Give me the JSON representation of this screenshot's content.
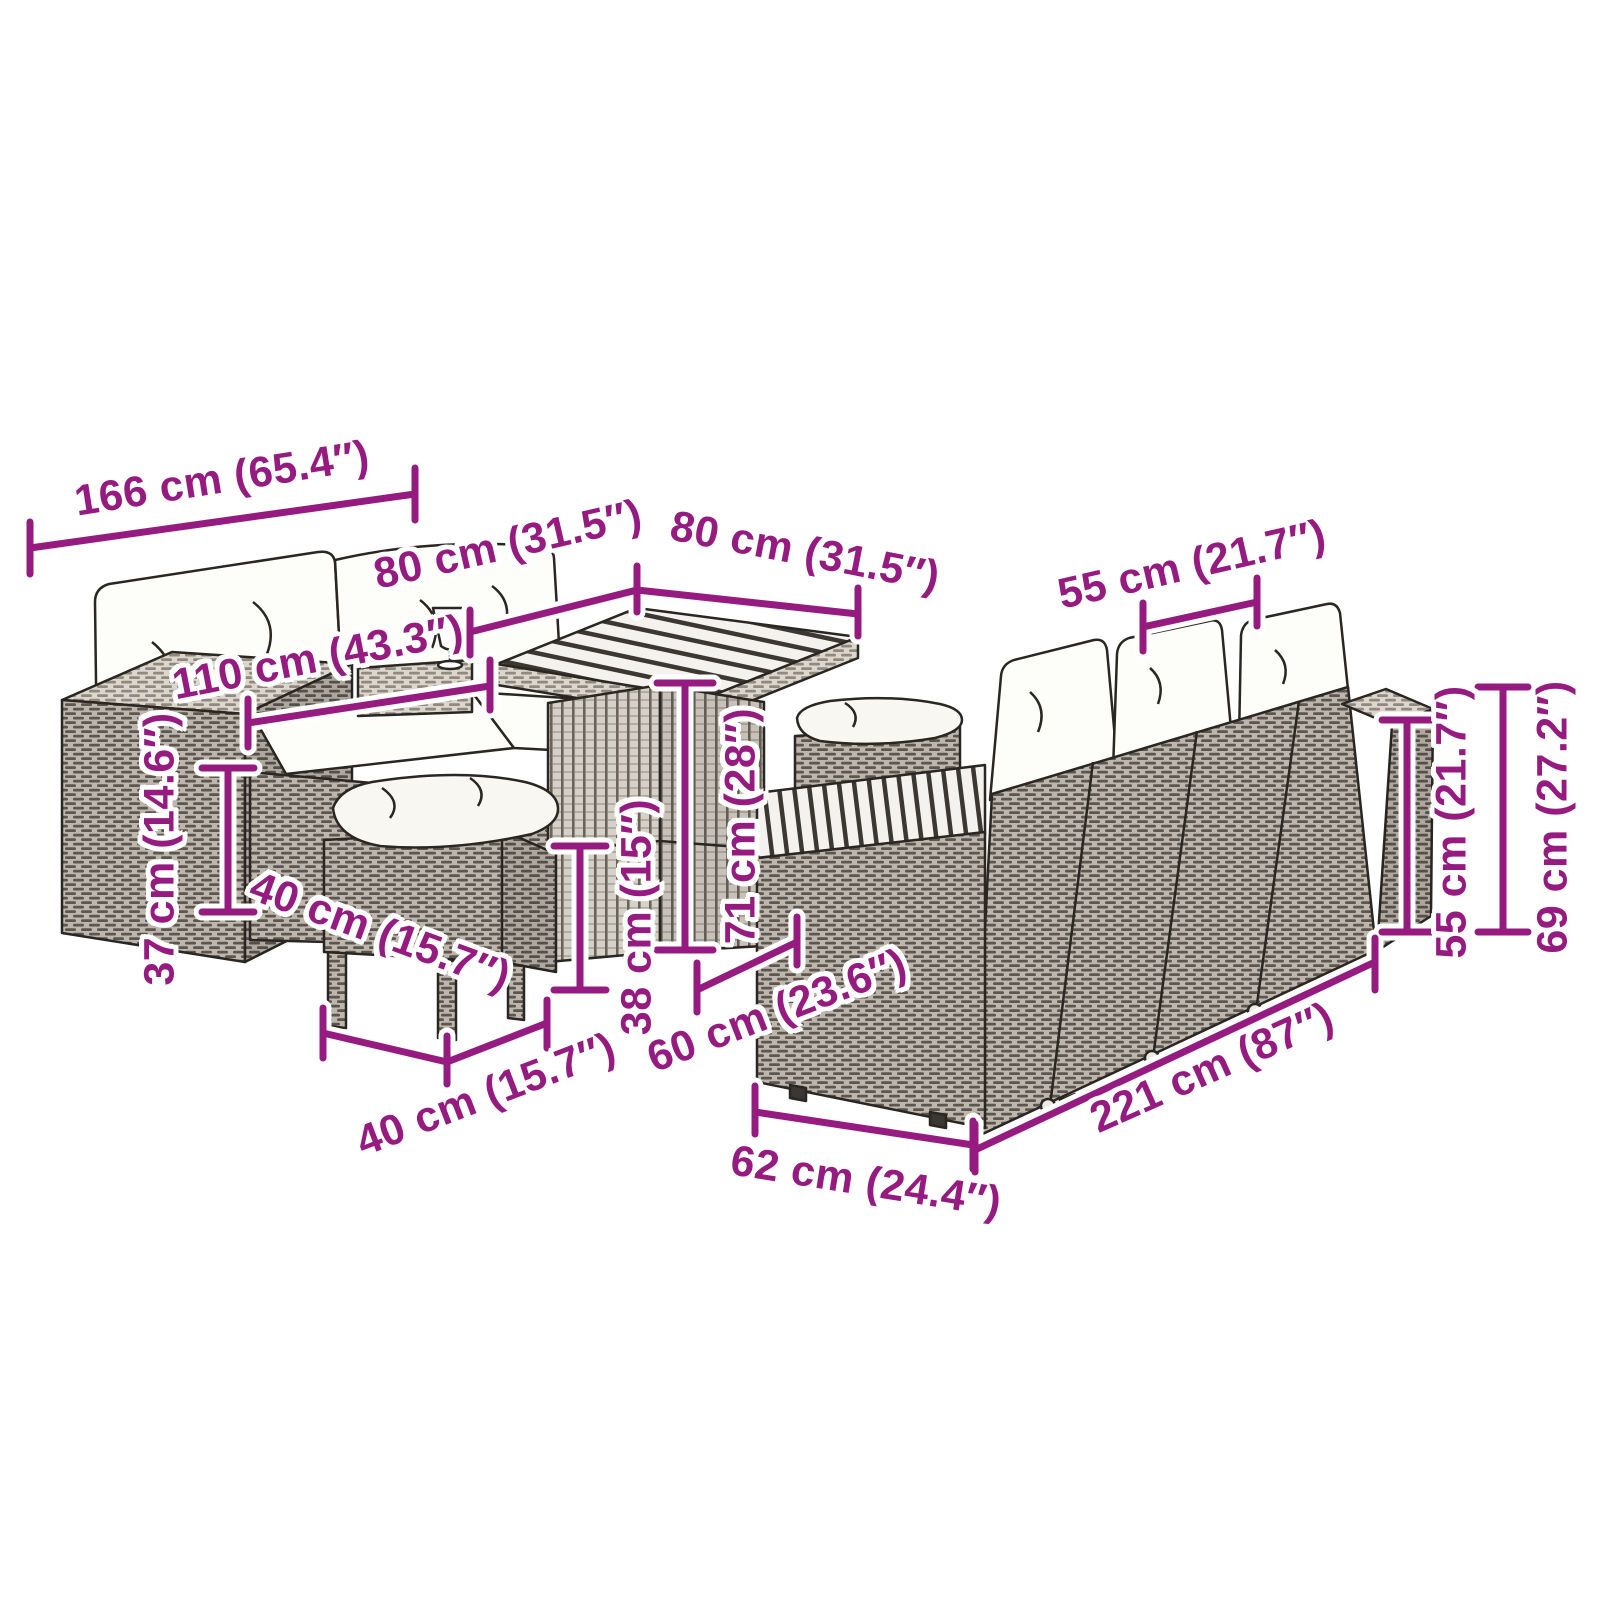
{
  "page": {
    "background": "#ffffff",
    "kind": "furniture-set-dimension-diagram"
  },
  "colors": {
    "dimension_annotation": "#951b81",
    "halo": "#ffffff",
    "line_art_outline": "#2a2622",
    "rattan_gray": "#bcb6ad",
    "cushion_white": "#fdfdfa"
  },
  "furniture": {
    "items": [
      {
        "name": "two-seater-sofa-with-cushions"
      },
      {
        "name": "square-slat-top-table"
      },
      {
        "name": "front-stool-with-cushion"
      },
      {
        "name": "rear-stool-with-cushion"
      },
      {
        "name": "corner-sofa-with-cushions"
      },
      {
        "name": "wine-glass"
      }
    ]
  },
  "dimensions": [
    {
      "id": "sofa-width",
      "label": "166 cm (65.4″)"
    },
    {
      "id": "table-top-width",
      "label": "80 cm (31.5″)"
    },
    {
      "id": "table-top-depth",
      "label": "80 cm (31.5″)"
    },
    {
      "id": "seat-section-width",
      "label": "55 cm (21.7″)"
    },
    {
      "id": "bench-width",
      "label": "110 cm (43.3″)"
    },
    {
      "id": "armrest-height",
      "label": "37 cm (14.6″)"
    },
    {
      "id": "stool-width",
      "label": "40 cm (15.7″)"
    },
    {
      "id": "stool-depth",
      "label": "40 cm (15.7″)"
    },
    {
      "id": "stool-height",
      "label": "38 cm (15″)"
    },
    {
      "id": "table-height",
      "label": "71 cm (28″)"
    },
    {
      "id": "seat-depth",
      "label": "60 cm (23.6″)"
    },
    {
      "id": "sofa-depth",
      "label": "62 cm (24.4″)"
    },
    {
      "id": "corner-sofa-length",
      "label": "221 cm (87″)"
    },
    {
      "id": "backrest-height",
      "label": "55 cm (21.7″)"
    },
    {
      "id": "total-height",
      "label": "69 cm (27.2″)"
    }
  ]
}
